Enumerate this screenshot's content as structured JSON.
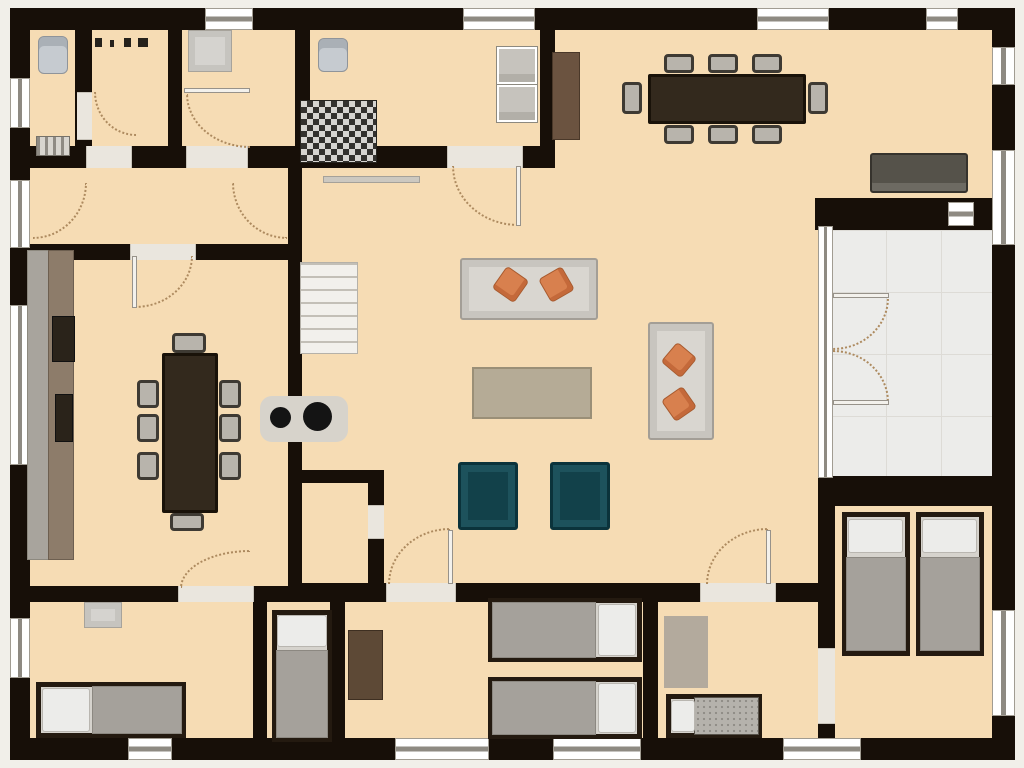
{
  "canvas": {
    "w": 1024,
    "h": 768,
    "bg": "#f1efe9"
  },
  "palette": {
    "floor": "#f6dcb4",
    "wall": "#170f08",
    "outside": "#f1efe9",
    "terrace": "#ececea",
    "window": "#ffffff",
    "door_arc": "#ad8a5f",
    "sofa": "#d9d6d0",
    "cushion_orange": "#d8804e",
    "armchair_teal": "#12414a",
    "table_wood_dark": "#33291d",
    "blanket_gray": "#a5a19b",
    "pillow_white": "#ececea"
  },
  "items": [
    {
      "n": "floor-main",
      "c": "floor",
      "x": 27,
      "y": 27,
      "w": 967,
      "h": 713
    },
    {
      "n": "terrace-floor",
      "c": "terrace",
      "x": 830,
      "y": 228,
      "w": 164,
      "h": 252
    },
    {
      "n": "wall-outer-top",
      "c": "wall",
      "x": 10,
      "y": 8,
      "w": 1005,
      "h": 22
    },
    {
      "n": "wall-outer-left",
      "c": "wall",
      "x": 10,
      "y": 8,
      "w": 20,
      "h": 752
    },
    {
      "n": "wall-outer-bottom",
      "c": "wall",
      "x": 10,
      "y": 738,
      "w": 1005,
      "h": 22
    },
    {
      "n": "wall-outer-right",
      "c": "wall",
      "x": 992,
      "y": 8,
      "w": 23,
      "h": 752
    },
    {
      "n": "wall-toprooms-bottom",
      "c": "wall",
      "x": 27,
      "y": 146,
      "w": 528,
      "h": 22
    },
    {
      "n": "wall-foyer-dining",
      "c": "wall",
      "x": 10,
      "y": 244,
      "w": 292,
      "h": 16
    },
    {
      "n": "wall-wc-right",
      "c": "wall",
      "x": 75,
      "y": 27,
      "w": 17,
      "h": 119
    },
    {
      "n": "wall-hall-right",
      "c": "wall",
      "x": 168,
      "y": 27,
      "w": 14,
      "h": 119
    },
    {
      "n": "wall-storage-right",
      "c": "wall",
      "x": 295,
      "y": 27,
      "w": 15,
      "h": 119
    },
    {
      "n": "wall-kitchen-right",
      "c": "wall",
      "x": 540,
      "y": 8,
      "w": 15,
      "h": 160
    },
    {
      "n": "wall-dining-great-divider",
      "c": "wall",
      "x": 288,
      "y": 166,
      "w": 14,
      "h": 422
    },
    {
      "n": "wall-closet-top",
      "c": "wall",
      "x": 288,
      "y": 470,
      "w": 96,
      "h": 13
    },
    {
      "n": "wall-closet-right",
      "c": "wall",
      "x": 368,
      "y": 470,
      "w": 16,
      "h": 118
    },
    {
      "n": "wall-terrace-top",
      "c": "wall",
      "x": 815,
      "y": 198,
      "w": 200,
      "h": 32
    },
    {
      "n": "wall-terrace-bottom",
      "c": "wall",
      "x": 818,
      "y": 476,
      "w": 197,
      "h": 30
    },
    {
      "n": "wall-greatroom-bottom",
      "c": "wall",
      "x": 300,
      "y": 583,
      "w": 520,
      "h": 19
    },
    {
      "n": "wall-diningroom-bottom",
      "c": "wall",
      "x": 10,
      "y": 586,
      "w": 292,
      "h": 16
    },
    {
      "n": "wall-bedroom1-right",
      "c": "wall",
      "x": 253,
      "y": 602,
      "w": 14,
      "h": 136
    },
    {
      "n": "wall-bedroom2-right",
      "c": "wall",
      "x": 330,
      "y": 602,
      "w": 15,
      "h": 136
    },
    {
      "n": "wall-bedroom3-right",
      "c": "wall",
      "x": 643,
      "y": 602,
      "w": 15,
      "h": 136
    },
    {
      "n": "wall-twinroom-left",
      "c": "wall",
      "x": 818,
      "y": 504,
      "w": 17,
      "h": 236
    },
    {
      "n": "window",
      "c": "window-h",
      "x": 205,
      "y": 8,
      "w": 48,
      "h": 22
    },
    {
      "n": "window",
      "c": "window-h",
      "x": 463,
      "y": 8,
      "w": 72,
      "h": 22
    },
    {
      "n": "window",
      "c": "window-h",
      "x": 757,
      "y": 8,
      "w": 72,
      "h": 22
    },
    {
      "n": "window",
      "c": "window-h",
      "x": 926,
      "y": 8,
      "w": 32,
      "h": 22
    },
    {
      "n": "window",
      "c": "window-v",
      "x": 10,
      "y": 78,
      "w": 20,
      "h": 50
    },
    {
      "n": "window",
      "c": "window-v",
      "x": 10,
      "y": 180,
      "w": 20,
      "h": 68
    },
    {
      "n": "window",
      "c": "window-v",
      "x": 10,
      "y": 305,
      "w": 20,
      "h": 160
    },
    {
      "n": "window",
      "c": "window-v",
      "x": 10,
      "y": 618,
      "w": 20,
      "h": 60
    },
    {
      "n": "window",
      "c": "window-h",
      "x": 128,
      "y": 738,
      "w": 44,
      "h": 22
    },
    {
      "n": "window",
      "c": "window-h",
      "x": 395,
      "y": 738,
      "w": 94,
      "h": 22
    },
    {
      "n": "window",
      "c": "window-h",
      "x": 553,
      "y": 738,
      "w": 88,
      "h": 22
    },
    {
      "n": "window",
      "c": "window-h",
      "x": 783,
      "y": 738,
      "w": 78,
      "h": 22
    },
    {
      "n": "window",
      "c": "window-v",
      "x": 992,
      "y": 47,
      "w": 23,
      "h": 38
    },
    {
      "n": "window",
      "c": "window-v",
      "x": 992,
      "y": 150,
      "w": 23,
      "h": 95
    },
    {
      "n": "window",
      "c": "window-v",
      "x": 992,
      "y": 610,
      "w": 23,
      "h": 106
    },
    {
      "n": "terrace-door-frame",
      "c": "window-v",
      "x": 818,
      "y": 226,
      "w": 15,
      "h": 252
    },
    {
      "n": "terrace-wall-vent",
      "c": "window-h",
      "x": 948,
      "y": 202,
      "w": 26,
      "h": 24
    },
    {
      "n": "door-opening",
      "c": "sill-h",
      "x": 86,
      "y": 146,
      "w": 46,
      "h": 22
    },
    {
      "n": "door-opening",
      "c": "sill-h",
      "x": 186,
      "y": 146,
      "w": 62,
      "h": 22
    },
    {
      "n": "door-opening",
      "c": "sill-h",
      "x": 447,
      "y": 146,
      "w": 76,
      "h": 22
    },
    {
      "n": "door-opening",
      "c": "sill-h",
      "x": 130,
      "y": 244,
      "w": 66,
      "h": 16
    },
    {
      "n": "door-opening",
      "c": "sill-h",
      "x": 386,
      "y": 583,
      "w": 70,
      "h": 19
    },
    {
      "n": "door-opening",
      "c": "sill-h",
      "x": 700,
      "y": 583,
      "w": 76,
      "h": 19
    },
    {
      "n": "door-opening",
      "c": "sill-h",
      "x": 178,
      "y": 586,
      "w": 76,
      "h": 16
    },
    {
      "n": "door-opening",
      "c": "sill-v",
      "x": 368,
      "y": 505,
      "w": 16,
      "h": 34
    },
    {
      "n": "door-opening",
      "c": "sill-v",
      "x": 818,
      "y": 648,
      "w": 17,
      "h": 76
    },
    {
      "n": "open-door-leaf",
      "c": "sill-v",
      "x": 77,
      "y": 92,
      "w": 15,
      "h": 48
    },
    {
      "n": "door-swing",
      "c": "arc-bl",
      "x": 94,
      "y": 92,
      "w": 42,
      "h": 44
    },
    {
      "n": "door-swing",
      "c": "arc-bl",
      "x": 186,
      "y": 94,
      "w": 64,
      "h": 54
    },
    {
      "n": "door-leaf",
      "c": "leaf",
      "x": 184,
      "y": 88,
      "w": 66,
      "h": 5
    },
    {
      "n": "door-swing",
      "c": "arc-br",
      "x": 33,
      "y": 183,
      "w": 54,
      "h": 56
    },
    {
      "n": "door-swing",
      "c": "arc-bl",
      "x": 232,
      "y": 183,
      "w": 55,
      "h": 56
    },
    {
      "n": "door-swing",
      "c": "arc-br",
      "x": 135,
      "y": 256,
      "w": 58,
      "h": 52
    },
    {
      "n": "door-leaf",
      "c": "leaf",
      "x": 132,
      "y": 256,
      "w": 5,
      "h": 52
    },
    {
      "n": "door-swing",
      "c": "arc-bl",
      "x": 452,
      "y": 166,
      "w": 66,
      "h": 60
    },
    {
      "n": "door-leaf",
      "c": "leaf",
      "x": 516,
      "y": 166,
      "w": 5,
      "h": 60
    },
    {
      "n": "door-swing",
      "c": "arc-tl",
      "x": 388,
      "y": 528,
      "w": 62,
      "h": 56
    },
    {
      "n": "door-leaf",
      "c": "leaf",
      "x": 448,
      "y": 530,
      "w": 5,
      "h": 54
    },
    {
      "n": "door-swing",
      "c": "arc-tl",
      "x": 706,
      "y": 528,
      "w": 62,
      "h": 56
    },
    {
      "n": "door-leaf",
      "c": "leaf",
      "x": 766,
      "y": 530,
      "w": 5,
      "h": 54
    },
    {
      "n": "door-swing",
      "c": "arc-tl",
      "x": 180,
      "y": 550,
      "w": 70,
      "h": 38
    },
    {
      "n": "door-swing",
      "c": "arc-br",
      "x": 833,
      "y": 298,
      "w": 56,
      "h": 52
    },
    {
      "n": "door-leaf",
      "c": "leaf",
      "x": 833,
      "y": 293,
      "w": 56,
      "h": 5
    },
    {
      "n": "door-swing",
      "c": "arc-tr",
      "x": 833,
      "y": 350,
      "w": 56,
      "h": 52
    },
    {
      "n": "door-leaf",
      "c": "leaf",
      "x": 833,
      "y": 400,
      "w": 56,
      "h": 5
    },
    {
      "n": "staircase",
      "c": "stairs",
      "x": 300,
      "y": 262,
      "w": 58,
      "h": 92
    },
    {
      "n": "toilet",
      "c": "porcelain",
      "x": 38,
      "y": 36,
      "w": 30,
      "h": 38
    },
    {
      "n": "radiator",
      "c": "radiator",
      "x": 36,
      "y": 136,
      "w": 34,
      "h": 20
    },
    {
      "n": "coat-hook",
      "c": "hook",
      "x": 95,
      "y": 38,
      "w": 7,
      "h": 9
    },
    {
      "n": "coat-hook",
      "c": "hook",
      "x": 110,
      "y": 40,
      "w": 4,
      "h": 7
    },
    {
      "n": "coat-hook",
      "c": "hook",
      "x": 124,
      "y": 38,
      "w": 7,
      "h": 9
    },
    {
      "n": "coat-hook",
      "c": "hook",
      "x": 138,
      "y": 38,
      "w": 10,
      "h": 9
    },
    {
      "n": "storage-cabinet",
      "c": "gray-box",
      "x": 188,
      "y": 30,
      "w": 44,
      "h": 42
    },
    {
      "n": "laundry-sink",
      "c": "porcelain",
      "x": 318,
      "y": 38,
      "w": 30,
      "h": 34
    },
    {
      "n": "appliance-unit",
      "c": "checker",
      "x": 300,
      "y": 100,
      "w": 77,
      "h": 63
    },
    {
      "n": "washer",
      "c": "appliance",
      "x": 497,
      "y": 47,
      "w": 40,
      "h": 37
    },
    {
      "n": "dryer",
      "c": "appliance",
      "x": 497,
      "y": 85,
      "w": 40,
      "h": 37
    },
    {
      "n": "kitchen-counter",
      "c": "woodbar",
      "x": 552,
      "y": 52,
      "w": 28,
      "h": 88
    },
    {
      "n": "wall-shelf",
      "c": "shelf",
      "x": 323,
      "y": 176,
      "w": 97,
      "h": 7
    },
    {
      "n": "dining-table",
      "c": "table-dark",
      "x": 648,
      "y": 74,
      "w": 158,
      "h": 50
    },
    {
      "n": "dining-chair",
      "c": "chair",
      "x": 664,
      "y": 54,
      "w": 30,
      "h": 19
    },
    {
      "n": "dining-chair",
      "c": "chair",
      "x": 708,
      "y": 54,
      "w": 30,
      "h": 19
    },
    {
      "n": "dining-chair",
      "c": "chair",
      "x": 752,
      "y": 54,
      "w": 30,
      "h": 19
    },
    {
      "n": "dining-chair",
      "c": "chair",
      "x": 664,
      "y": 125,
      "w": 30,
      "h": 19
    },
    {
      "n": "dining-chair",
      "c": "chair",
      "x": 708,
      "y": 125,
      "w": 30,
      "h": 19
    },
    {
      "n": "dining-chair",
      "c": "chair",
      "x": 752,
      "y": 125,
      "w": 30,
      "h": 19
    },
    {
      "n": "dining-chair",
      "c": "chair",
      "x": 622,
      "y": 82,
      "w": 20,
      "h": 32
    },
    {
      "n": "dining-chair",
      "c": "chair",
      "x": 808,
      "y": 82,
      "w": 20,
      "h": 32
    },
    {
      "n": "sideboard",
      "c": "sideboard",
      "x": 870,
      "y": 153,
      "w": 98,
      "h": 40
    },
    {
      "n": "sofa",
      "c": "sofa",
      "x": 460,
      "y": 258,
      "w": 138,
      "h": 62
    },
    {
      "n": "sofa-cushion",
      "c": "pillow-orange",
      "x": 497,
      "y": 271,
      "w": 27,
      "h": 27,
      "r": 35
    },
    {
      "n": "sofa-cushion",
      "c": "pillow-orange",
      "x": 543,
      "y": 271,
      "w": 27,
      "h": 27,
      "r": -30
    },
    {
      "n": "coffee-table",
      "c": "rug-tan",
      "x": 472,
      "y": 367,
      "w": 120,
      "h": 52
    },
    {
      "n": "sofa",
      "c": "sofa",
      "x": 648,
      "y": 322,
      "w": 66,
      "h": 118
    },
    {
      "n": "sofa-cushion",
      "c": "pillow-orange",
      "x": 666,
      "y": 347,
      "w": 26,
      "h": 26,
      "r": 40
    },
    {
      "n": "sofa-cushion",
      "c": "pillow-orange",
      "x": 666,
      "y": 391,
      "w": 26,
      "h": 26,
      "r": -35
    },
    {
      "n": "armchair",
      "c": "armchair",
      "x": 458,
      "y": 462,
      "w": 60,
      "h": 68
    },
    {
      "n": "armchair",
      "c": "armchair",
      "x": 550,
      "y": 462,
      "w": 60,
      "h": 68
    },
    {
      "n": "wood-stove",
      "c": "stove-base",
      "x": 260,
      "y": 396,
      "w": 88,
      "h": 46
    },
    {
      "n": "stove-burner",
      "c": "dark-circle",
      "x": 270,
      "y": 407,
      "w": 21,
      "h": 21
    },
    {
      "n": "stove-burner",
      "c": "dark-circle",
      "x": 303,
      "y": 402,
      "w": 29,
      "h": 29
    },
    {
      "n": "kitchen-counter",
      "c": "counter",
      "x": 27,
      "y": 250,
      "w": 23,
      "h": 310
    },
    {
      "n": "kitchen-counter-top",
      "c": "woodbar2",
      "x": 48,
      "y": 250,
      "w": 26,
      "h": 310
    },
    {
      "n": "cooktop",
      "c": "dark-appliance",
      "x": 52,
      "y": 316,
      "w": 23,
      "h": 46
    },
    {
      "n": "counter-sink",
      "c": "dark-appliance",
      "x": 55,
      "y": 394,
      "w": 18,
      "h": 48
    },
    {
      "n": "dining-table",
      "c": "table-dark",
      "x": 162,
      "y": 353,
      "w": 56,
      "h": 160
    },
    {
      "n": "dining-chair",
      "c": "chair",
      "x": 137,
      "y": 380,
      "w": 22,
      "h": 28
    },
    {
      "n": "dining-chair",
      "c": "chair",
      "x": 137,
      "y": 414,
      "w": 22,
      "h": 28
    },
    {
      "n": "dining-chair",
      "c": "chair",
      "x": 137,
      "y": 452,
      "w": 22,
      "h": 28
    },
    {
      "n": "dining-chair",
      "c": "chair",
      "x": 219,
      "y": 380,
      "w": 22,
      "h": 28
    },
    {
      "n": "dining-chair",
      "c": "chair",
      "x": 219,
      "y": 414,
      "w": 22,
      "h": 28
    },
    {
      "n": "dining-chair",
      "c": "chair",
      "x": 219,
      "y": 452,
      "w": 22,
      "h": 28
    },
    {
      "n": "dining-chair",
      "c": "chair",
      "x": 172,
      "y": 333,
      "w": 34,
      "h": 20
    },
    {
      "n": "dining-chair",
      "c": "chair",
      "x": 170,
      "y": 513,
      "w": 34,
      "h": 18
    },
    {
      "n": "nightstand",
      "c": "gray-box",
      "x": 84,
      "y": 602,
      "w": 38,
      "h": 26
    },
    {
      "n": "bed",
      "c": "bedframe",
      "x": 36,
      "y": 682,
      "w": 150,
      "h": 56
    },
    {
      "n": "bed-blanket",
      "c": "blanket",
      "x": 92,
      "y": 686,
      "w": 90,
      "h": 48
    },
    {
      "n": "bed-pillow",
      "c": "pillow",
      "x": 42,
      "y": 688,
      "w": 48,
      "h": 44
    },
    {
      "n": "bed",
      "c": "bedframe",
      "x": 272,
      "y": 610,
      "w": 60,
      "h": 132
    },
    {
      "n": "bed-blanket",
      "c": "blanket",
      "x": 276,
      "y": 650,
      "w": 52,
      "h": 88
    },
    {
      "n": "bed-pillow",
      "c": "pillow",
      "x": 277,
      "y": 615,
      "w": 50,
      "h": 32
    },
    {
      "n": "dresser",
      "c": "dresser",
      "x": 348,
      "y": 630,
      "w": 35,
      "h": 70
    },
    {
      "n": "bed",
      "c": "bedframe",
      "x": 488,
      "y": 598,
      "w": 154,
      "h": 64
    },
    {
      "n": "bed-blanket",
      "c": "blanket",
      "x": 492,
      "y": 602,
      "w": 104,
      "h": 56
    },
    {
      "n": "bed-pillow",
      "c": "pillow",
      "x": 598,
      "y": 604,
      "w": 38,
      "h": 52
    },
    {
      "n": "bed",
      "c": "bedframe",
      "x": 488,
      "y": 677,
      "w": 154,
      "h": 62
    },
    {
      "n": "bed-blanket",
      "c": "blanket",
      "x": 492,
      "y": 681,
      "w": 104,
      "h": 54
    },
    {
      "n": "bed-pillow",
      "c": "pillow",
      "x": 598,
      "y": 683,
      "w": 38,
      "h": 50
    },
    {
      "n": "rug",
      "c": "rug",
      "x": 664,
      "y": 616,
      "w": 44,
      "h": 72
    },
    {
      "n": "crib",
      "c": "bedframe",
      "x": 666,
      "y": 694,
      "w": 96,
      "h": 44
    },
    {
      "n": "crib-blanket",
      "c": "dotted-tex",
      "x": 694,
      "y": 697,
      "w": 65,
      "h": 38
    },
    {
      "n": "crib-pillow",
      "c": "pillow",
      "x": 671,
      "y": 700,
      "w": 24,
      "h": 32
    },
    {
      "n": "bed",
      "c": "bedframe",
      "x": 842,
      "y": 512,
      "w": 68,
      "h": 144
    },
    {
      "n": "bed-blanket",
      "c": "blanket",
      "x": 846,
      "y": 557,
      "w": 60,
      "h": 94
    },
    {
      "n": "bed-pillow",
      "c": "pillow",
      "x": 848,
      "y": 519,
      "w": 55,
      "h": 34
    },
    {
      "n": "bed",
      "c": "bedframe",
      "x": 916,
      "y": 512,
      "w": 68,
      "h": 144
    },
    {
      "n": "bed-blanket",
      "c": "blanket",
      "x": 920,
      "y": 557,
      "w": 60,
      "h": 94
    },
    {
      "n": "bed-pillow",
      "c": "pillow",
      "x": 922,
      "y": 519,
      "w": 55,
      "h": 34
    }
  ]
}
